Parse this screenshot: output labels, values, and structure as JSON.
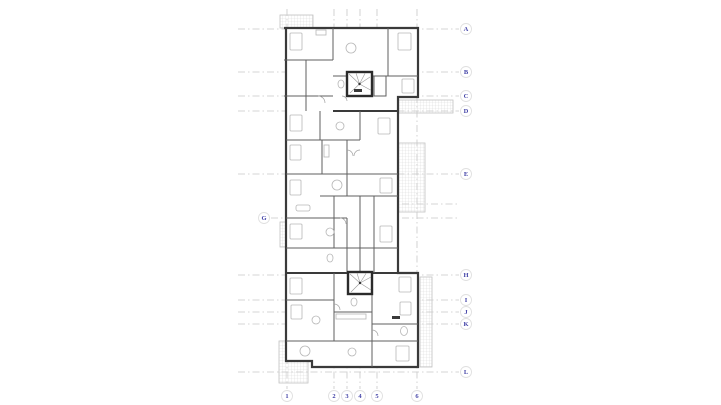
{
  "page": {
    "background": "#ffffff"
  },
  "drawing": {
    "type": "architectural-floor-plan",
    "colors": {
      "grid_line": "#c8c8c8",
      "bubble_fill": "#ffffff",
      "bubble_stroke": "#e0e0e0",
      "bubble_text": "#4545a8",
      "wall": "#3a3a3a",
      "interior_wall": "#5f5f5f",
      "fixture": "#b6b6b6",
      "hatch": "#d9d9d9"
    },
    "grid": {
      "bubble_radius": 5.5,
      "rows": [
        {
          "label": "A",
          "y": 29,
          "bubble": {
            "x": 466
          },
          "segments": [
            [
              238,
              459
            ]
          ]
        },
        {
          "label": "B",
          "y": 72,
          "bubble": {
            "x": 466
          },
          "segments": [
            [
              238,
              459
            ]
          ]
        },
        {
          "label": "C",
          "y": 96,
          "bubble": {
            "x": 466
          },
          "segments": [
            [
              238,
              459
            ]
          ]
        },
        {
          "label": "D",
          "y": 111,
          "bubble": {
            "x": 466
          },
          "segments": [
            [
              238,
              459
            ]
          ]
        },
        {
          "label": "E",
          "y": 174,
          "bubble": {
            "x": 466
          },
          "segments": [
            [
              238,
              459
            ]
          ]
        },
        {
          "label": "",
          "y": 204,
          "bubble": null,
          "segments": [
            [
              402,
              458
            ]
          ]
        },
        {
          "label": "G",
          "y": 218,
          "bubble": {
            "x": 264
          },
          "segments": [
            [
              271,
              288
            ],
            [
              402,
              458
            ]
          ]
        },
        {
          "label": "H",
          "y": 275,
          "bubble": {
            "x": 466
          },
          "segments": [
            [
              238,
              459
            ]
          ]
        },
        {
          "label": "I",
          "y": 300,
          "bubble": {
            "x": 466
          },
          "segments": [
            [
              238,
              459
            ]
          ]
        },
        {
          "label": "J",
          "y": 312,
          "bubble": {
            "x": 466
          },
          "segments": [
            [
              238,
              459
            ]
          ]
        },
        {
          "label": "K",
          "y": 324,
          "bubble": {
            "x": 466
          },
          "segments": [
            [
              238,
              459
            ]
          ]
        },
        {
          "label": "L",
          "y": 372,
          "bubble": {
            "x": 466
          },
          "segments": [
            [
              238,
              459
            ]
          ]
        }
      ],
      "cols": [
        {
          "label": "1",
          "x": 287,
          "bubble": {
            "y": 396
          },
          "segments": [
            [
              9,
              389
            ]
          ]
        },
        {
          "label": "2",
          "x": 334,
          "bubble": {
            "y": 396
          },
          "segments": [
            [
              9,
              389
            ]
          ]
        },
        {
          "label": "3",
          "x": 347,
          "bubble": {
            "y": 396
          },
          "segments": [
            [
              9,
              389
            ]
          ]
        },
        {
          "label": "4",
          "x": 360,
          "bubble": {
            "y": 396
          },
          "segments": [
            [
              9,
              389
            ]
          ]
        },
        {
          "label": "5",
          "x": 377,
          "bubble": {
            "y": 396
          },
          "segments": [
            [
              9,
              389
            ]
          ]
        },
        {
          "label": "6",
          "x": 417,
          "bubble": {
            "y": 396
          },
          "segments": [
            [
              9,
              389
            ]
          ]
        }
      ]
    }
  }
}
